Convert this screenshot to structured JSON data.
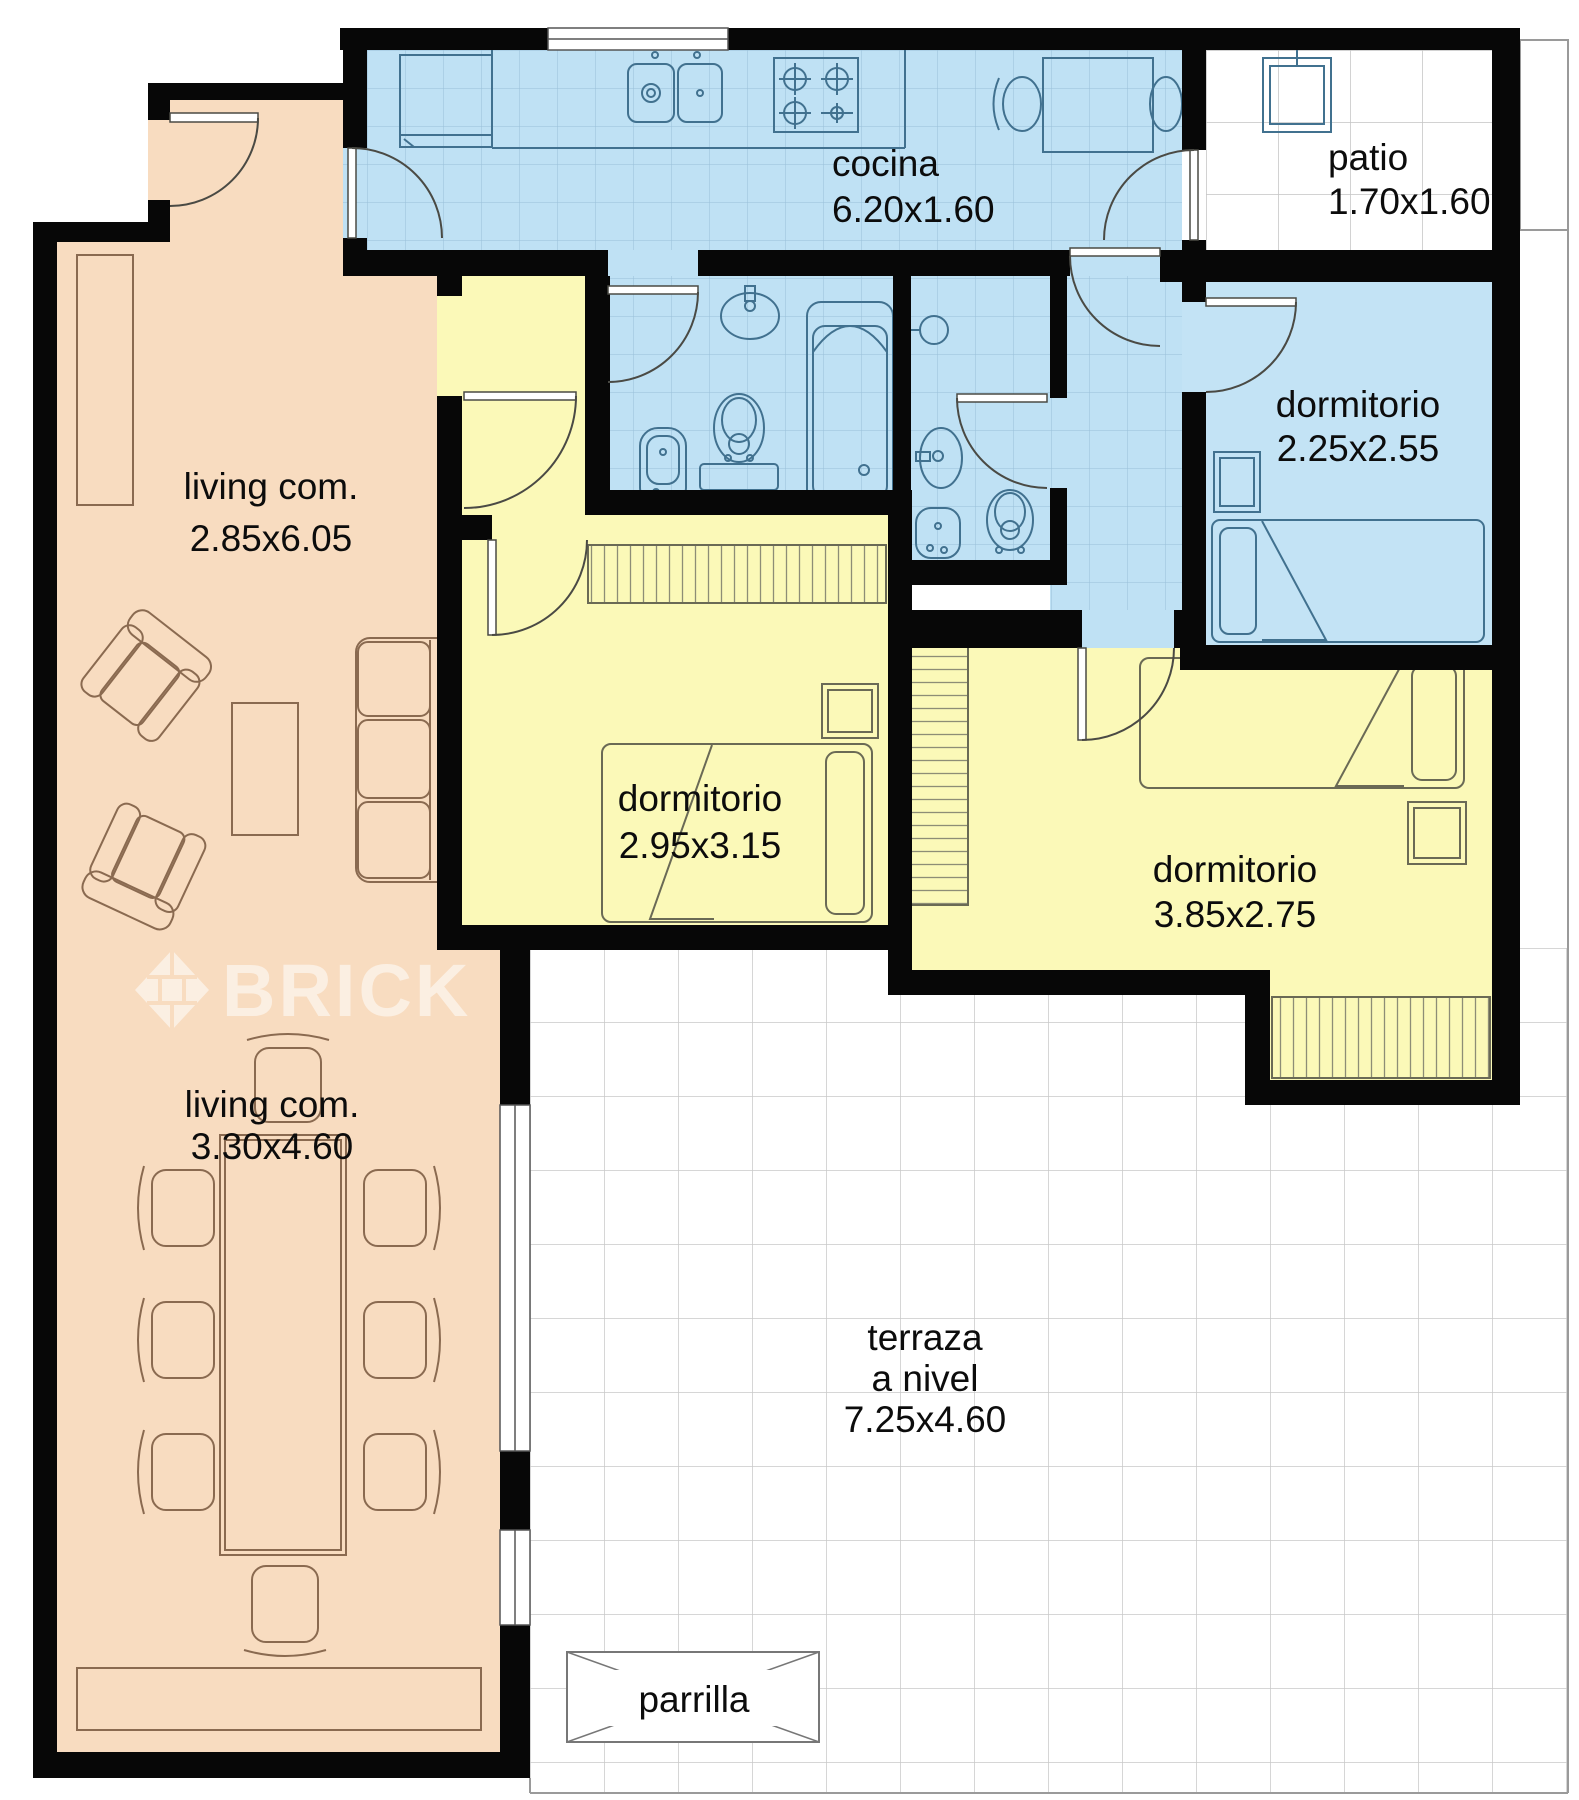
{
  "plan": {
    "watermark": "BRICK",
    "labels": {
      "cocina": {
        "name": "cocina",
        "dims": "6.20x1.60"
      },
      "patio": {
        "name": "patio",
        "dims": "1.70x1.60"
      },
      "living_upper": {
        "name": "living com.",
        "dims": "2.85x6.05"
      },
      "dorm_small": {
        "name": "dormitorio",
        "dims": "2.25x2.55"
      },
      "dorm_center": {
        "name": "dormitorio",
        "dims": "2.95x3.15"
      },
      "dorm_right": {
        "name": "dormitorio",
        "dims": "3.85x2.75"
      },
      "living_lower": {
        "name": "living com.",
        "dims": "3.30x4.60"
      },
      "terraza": {
        "line1": "terraza",
        "line2": "a nivel",
        "dims": "7.25x4.60"
      },
      "parrilla": {
        "name": "parrilla"
      }
    },
    "colors": {
      "living_fill": "#f8dcc0",
      "wet_area_fill": "#bfe1f4",
      "bedroom_fill": "#fbf9b8",
      "wall": "#070707",
      "tile_line_blue": "#7fa9c6",
      "tile_line_gray": "#c9c9c9"
    }
  }
}
